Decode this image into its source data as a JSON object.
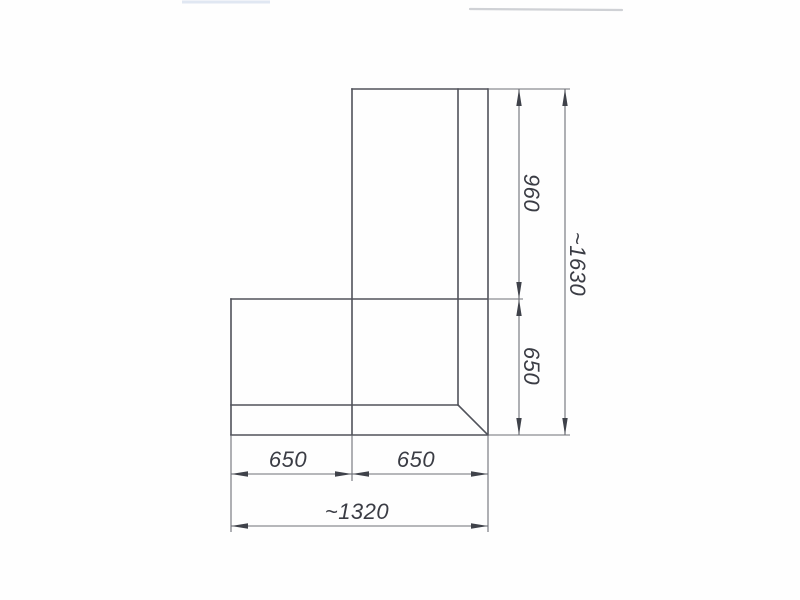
{
  "page": {
    "description": "Scanned technical plan drawing of an L-shaped corner unit with dimension annotations",
    "background_color": "#fefefe"
  },
  "drawing": {
    "shape_line_color": "#50525a",
    "dim_line_color": "#6e7077",
    "arrow_color": "#3f424a",
    "text_color": "#3a3c44",
    "dimensions": {
      "vertical_top_segment": "960",
      "vertical_bottom_segment": "650",
      "vertical_overall": "~1630",
      "horizontal_left_segment": "650",
      "horizontal_right_segment": "650",
      "horizontal_overall": "~1320"
    }
  }
}
